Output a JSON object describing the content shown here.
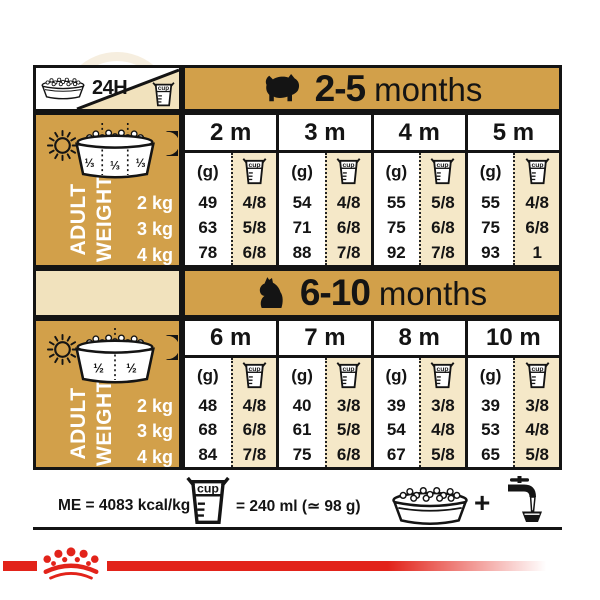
{
  "colors": {
    "gold": "#D2A04A",
    "cream": "#F5E8C8",
    "red": "#E2231A",
    "ink": "#141414"
  },
  "top": {
    "daily": "24H"
  },
  "labels": {
    "g": "(g)",
    "cup": "cup",
    "adult_line1": "ADULT",
    "adult_line2": "WEIGHT"
  },
  "sections": [
    {
      "range": "2-5",
      "suffix": "months",
      "months": [
        "2 m",
        "3 m",
        "4 m",
        "5 m"
      ],
      "portions": [
        "⅓",
        "⅓",
        "⅓"
      ],
      "weights": [
        "2 kg",
        "3 kg",
        "4 kg"
      ],
      "grams": [
        [
          49,
          54,
          55,
          55
        ],
        [
          63,
          71,
          75,
          75
        ],
        [
          78,
          88,
          92,
          93
        ]
      ],
      "cups": [
        [
          "4/8",
          "4/8",
          "5/8",
          "4/8"
        ],
        [
          "5/8",
          "6/8",
          "6/8",
          "6/8"
        ],
        [
          "6/8",
          "7/8",
          "7/8",
          "1"
        ]
      ]
    },
    {
      "range": "6-10",
      "suffix": "months",
      "months": [
        "6 m",
        "7 m",
        "8 m",
        "10 m"
      ],
      "portions": [
        "½",
        "½"
      ],
      "weights": [
        "2 kg",
        "3 kg",
        "4 kg"
      ],
      "grams": [
        [
          48,
          40,
          39,
          39
        ],
        [
          68,
          61,
          54,
          53
        ],
        [
          84,
          75,
          67,
          65
        ]
      ],
      "cups": [
        [
          "4/8",
          "3/8",
          "3/8",
          "3/8"
        ],
        [
          "6/8",
          "5/8",
          "4/8",
          "4/8"
        ],
        [
          "7/8",
          "6/8",
          "5/8",
          "5/8"
        ]
      ]
    }
  ],
  "footer": {
    "me": "ME = 4083 kcal/kg",
    "cup_equals": "= 240 ml (≃ 98 g)",
    "plus": "+"
  }
}
